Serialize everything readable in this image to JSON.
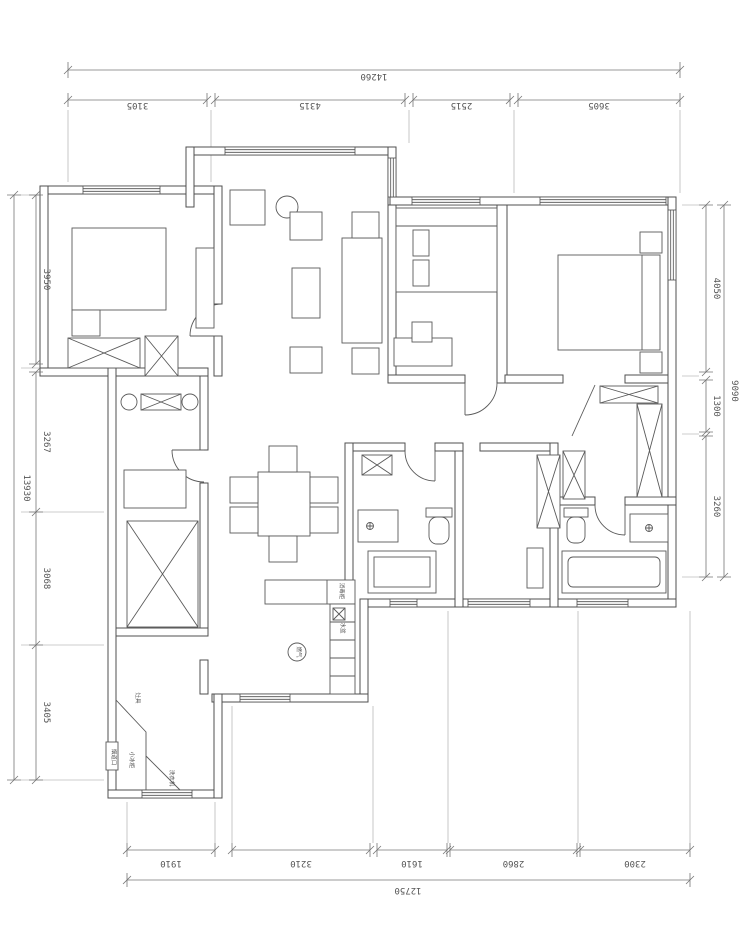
{
  "dimensions": {
    "top": {
      "overall": "14260",
      "segments": [
        "3105",
        "4315",
        "2515",
        "3605"
      ]
    },
    "bottom": {
      "overall": "12750",
      "segments": [
        "1910",
        "3210",
        "1610",
        "2860",
        "2300"
      ]
    },
    "left": {
      "overall": "13930",
      "segments": [
        "3950",
        "3267",
        "3068",
        "3405"
      ]
    },
    "right": {
      "overall": "9090",
      "segments": [
        "4050",
        "1300",
        "3260"
      ]
    }
  },
  "labels": {
    "stove": "灶具",
    "fridge": "小冰柜",
    "washer": "洗衣机",
    "flue": "烟道口",
    "sterilizer": "消毒柜",
    "sink": "水盆",
    "gas": "燃气"
  },
  "colors": {
    "wall_line": "#4f4f4f",
    "dim_line": "#767676",
    "background": "#ffffff"
  }
}
